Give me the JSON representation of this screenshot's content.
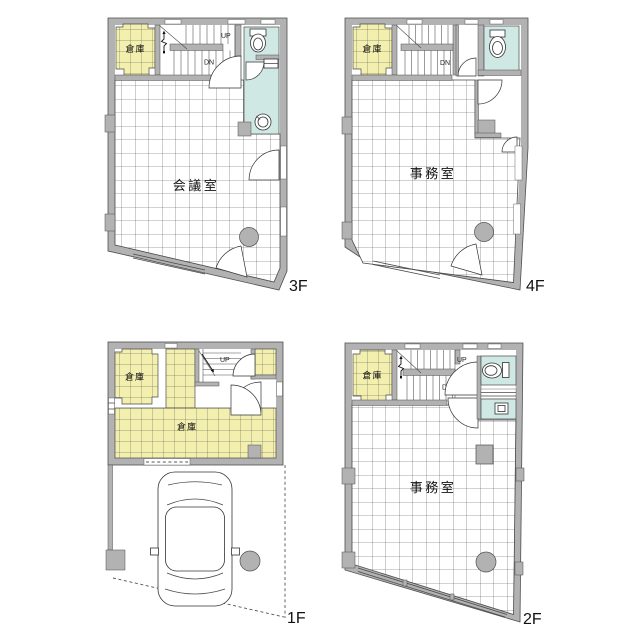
{
  "colors": {
    "background": "#ffffff",
    "wall": "#b2b2b2",
    "storage_fill": "#f3efae",
    "wet_area_fill": "#cfe8e3"
  },
  "floors": {
    "f3": {
      "label": "3F",
      "room_label": "会議室",
      "storage_label": "倉庫",
      "stairs_up": "UP",
      "stairs_down": "DN"
    },
    "f4": {
      "label": "4F",
      "room_label": "事務室",
      "storage_label": "倉庫",
      "stairs_down": "DN"
    },
    "f1": {
      "label": "1F",
      "storage_label_1": "倉庫",
      "storage_label_2": "倉庫",
      "stairs_up": "UP"
    },
    "f2": {
      "label": "2F",
      "room_label": "事務室",
      "storage_label": "倉庫",
      "stairs_up": "UP",
      "stairs_down": "DN"
    }
  }
}
